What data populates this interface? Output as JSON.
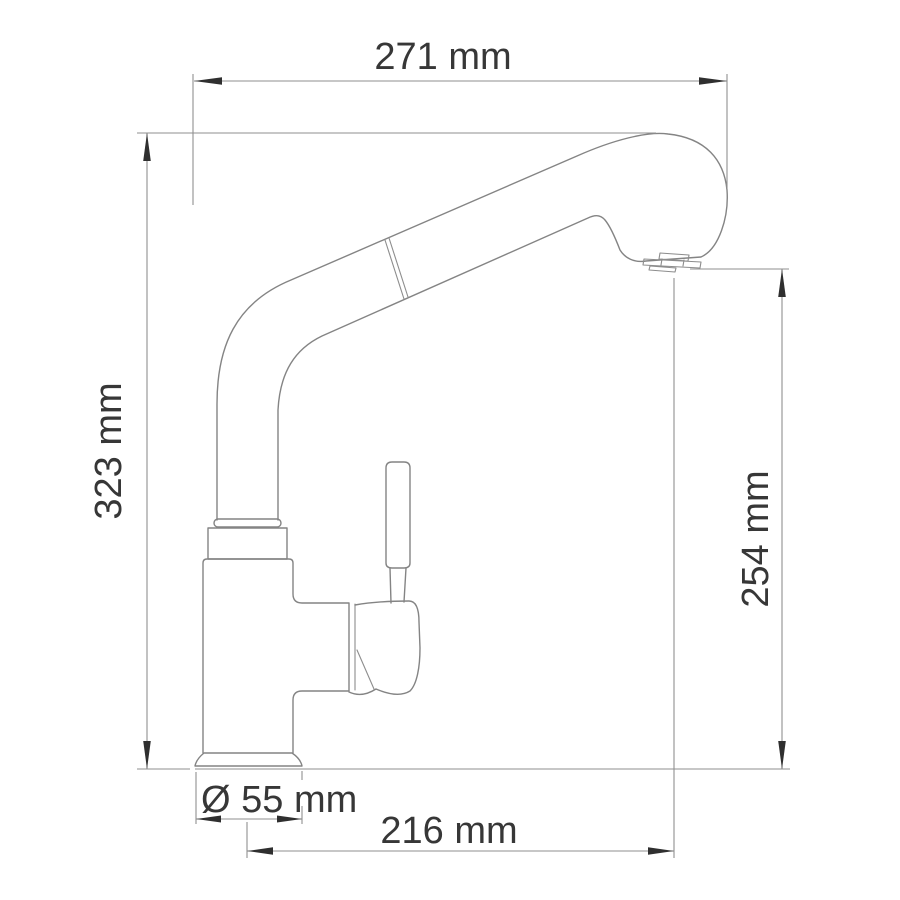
{
  "drawing": {
    "subject": "kitchen-faucet-side-view-technical-drawing",
    "units": "mm",
    "labels": {
      "overall_width": "271 mm",
      "overall_height": "323 mm",
      "spout_outlet_height": "254 mm",
      "base_diameter": "Ø 55 mm",
      "spout_reach": "216 mm"
    },
    "values": {
      "overall_width_mm": 271,
      "overall_height_mm": 323,
      "spout_outlet_height_mm": 254,
      "base_diameter_mm": 55,
      "spout_reach_mm": 216
    },
    "colors": {
      "background": "#ffffff",
      "object_line": "#848484",
      "dimension_line": "#8f8f8f",
      "arrow": "#2f2f2f",
      "text": "#373737"
    }
  }
}
